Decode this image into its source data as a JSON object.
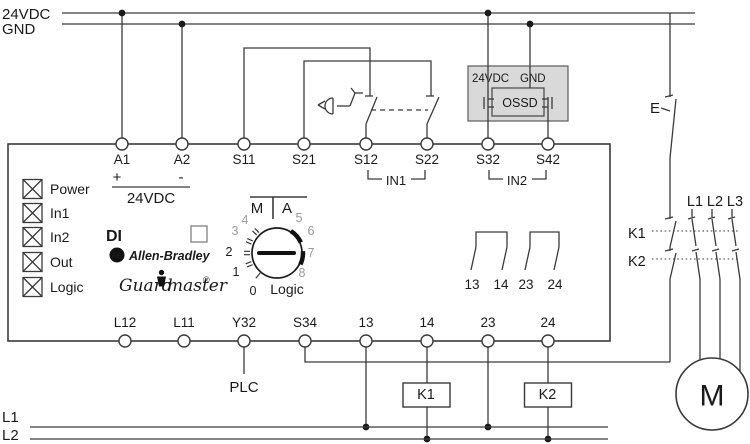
{
  "rails": {
    "v24": "24VDC",
    "gnd": "GND"
  },
  "top_terminals": [
    "A1",
    "A2",
    "S11",
    "S21",
    "S12",
    "S22",
    "S32",
    "S42"
  ],
  "supply": {
    "plus": "+",
    "minus": "-",
    "label": "24VDC"
  },
  "input_groups": {
    "in1": "IN1",
    "in2": "IN2"
  },
  "ossd": {
    "v24": "24VDC",
    "gnd": "GND",
    "label": "OSSD"
  },
  "indicators": [
    "Power",
    "In1",
    "In2",
    "Out",
    "Logic"
  ],
  "branding": {
    "model": "DI",
    "ab_monogram": "AB",
    "brand": "Allen-Bradley",
    "family_left": "Guard",
    "family_right": "master",
    "registered": "®"
  },
  "dial": {
    "mode_m": "M",
    "mode_a": "A",
    "label": "Logic",
    "positions_black": [
      "0",
      "1",
      "2"
    ],
    "positions_gray": [
      "3",
      "4",
      "5",
      "6",
      "7",
      "8"
    ]
  },
  "output_contacts": [
    "13",
    "14",
    "23",
    "24"
  ],
  "bottom_terminals": [
    "L12",
    "L11",
    "Y32",
    "S34",
    "13",
    "14",
    "23",
    "24"
  ],
  "plc": "PLC",
  "reset": {
    "label": "E"
  },
  "phases": [
    "L1",
    "L2",
    "L3"
  ],
  "contactors": {
    "k1": "K1",
    "k2": "K2"
  },
  "motor": "M",
  "bottom_rails": {
    "l1": "L1",
    "l2": "L2"
  },
  "colors": {
    "line": "#3a3a3a",
    "gray_text": "#9a9a9a",
    "ossd_fill": "#d9d9d9"
  }
}
